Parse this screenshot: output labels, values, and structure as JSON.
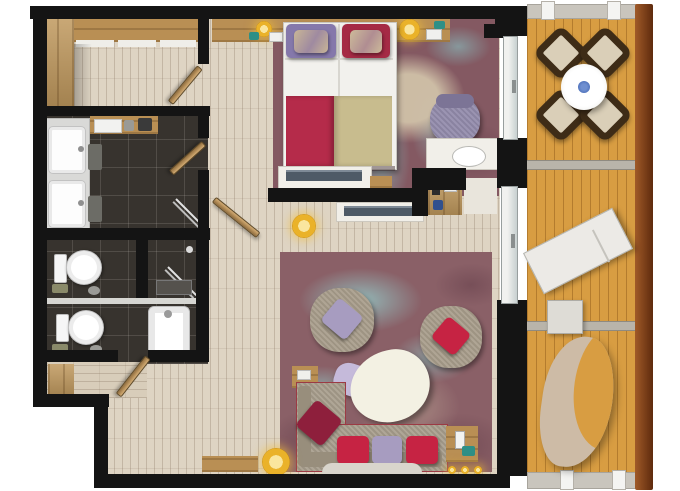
{
  "image": {
    "type": "apartment-floor-plan",
    "width_px": 680,
    "height_px": 491,
    "visible_text": "none"
  },
  "palette": {
    "wall": "#141414",
    "wood_floor": "#ded4c3",
    "bathroom_tile": "#37332e",
    "wardrobe_wood": "#c0995e",
    "balcony_deck": "#d89d42",
    "balcony_railing": "#8a4a1f",
    "carpet_base": "#8a6067",
    "carpet_teal_accent": "#8fd0cc",
    "carpet_beige_accent": "#cdbfa6",
    "sofa_fabric": "#a99f8e",
    "cushion_red": "#c62343",
    "cushion_lavender": "#a79cc0",
    "cushion_dark_red": "#8e1f3c",
    "pillow_purple": "#8578ab",
    "pillow_crimson": "#a52a45",
    "blanket_red": "#b52b4a",
    "blanket_khaki": "#c8bc8e",
    "dining_chair": "#3e2c17",
    "dining_chair_cushion": "#dacfb8",
    "table_white": "#f1efe8",
    "lamp_gold": "#eab229",
    "tv_screen": "#4e5a66",
    "bowl_blue": "#3a5fae"
  },
  "rooms": [
    {
      "id": "dressing-area",
      "floor": "wood-planks",
      "furniture": [
        "l-shaped-wardrobe",
        "closet-door"
      ]
    },
    {
      "id": "bathroom",
      "floor": "dark-tile",
      "furniture": [
        "double-vanity-sink",
        "wood-shelf",
        "laundry-stools",
        "glass-shower-screen",
        "bathroom-door"
      ]
    },
    {
      "id": "wc-1",
      "floor": "dark-tile",
      "furniture": [
        "toilet",
        "towel-stack"
      ]
    },
    {
      "id": "shower-room",
      "floor": "dark-tile",
      "furniture": [
        "glass-screen",
        "shower-tray"
      ]
    },
    {
      "id": "wc-2",
      "floor": "dark-tile",
      "furniture": [
        "toilet",
        "bathtub",
        "door"
      ]
    },
    {
      "id": "entry-hall",
      "floor": "wood-planks",
      "furniture": [
        "wood-panel",
        "floor-lamp",
        "hall-door"
      ]
    },
    {
      "id": "bedroom",
      "floor": "carpet-over-wood",
      "furniture": [
        "double-bed",
        "purple-pillow-set",
        "crimson-pillow-set",
        "red-and-khaki-blanket",
        "headboard-shelf",
        "two-bedside-lamps",
        "phone",
        "armchair",
        "desk-with-chair",
        "tv-console",
        "minibar-cabinet"
      ]
    },
    {
      "id": "living-room",
      "floor": "carpet-over-wood",
      "furniture": [
        "l-shaped-sofa",
        "red-cushions",
        "lavender-cushion",
        "dark-red-corner-cushion",
        "organic-coffee-table",
        "lavender-pouf",
        "armchair-lavender-cushion",
        "armchair-red-cushion",
        "wood-side-table-left",
        "wood-side-table-right",
        "rug",
        "floor-lamp",
        "tv-console",
        "wood-bench",
        "spotlights"
      ]
    },
    {
      "id": "balcony",
      "floor": "orange-deck",
      "furniture": [
        "round-dining-table",
        "blue-bowl",
        "four-diamond-chairs",
        "sun-lounger",
        "small-side-table",
        "hanging-lounger",
        "wood-railing",
        "gray-balustrades"
      ]
    }
  ]
}
